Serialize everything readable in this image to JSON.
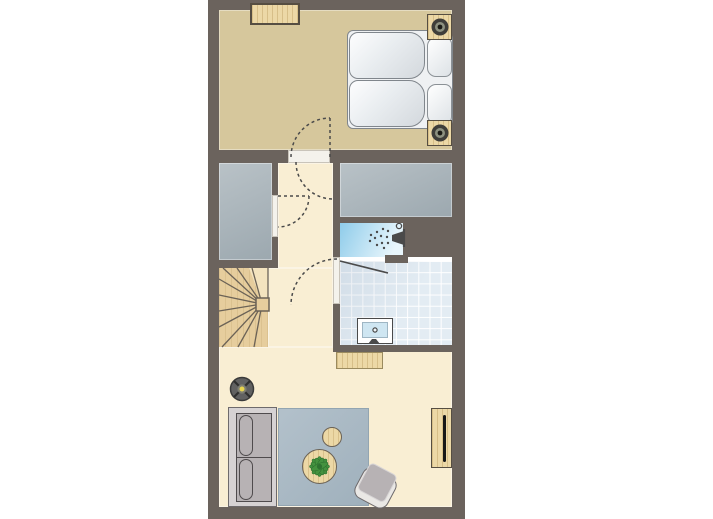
{
  "page": {
    "background": "#ffffff",
    "type": "floor-plan"
  },
  "colors": {
    "page": "#ffffff",
    "wall": "#6b635d",
    "bedroom": "#d6c79c",
    "cream": "#f9eed3",
    "grayroom-hi": "#b9c2c7",
    "grayroom-lo": "#9ca8af",
    "shower-hi": "#8fccea",
    "shower-lo": "#e9f6fc",
    "tile": "#e3ecf3",
    "grout": "#ffffff",
    "threshold": "#f4f2ec",
    "wood": "#ecd8a6",
    "wood-border": "#564e42",
    "stairs": "#e6cd9d",
    "stairs-light": "#f3e3bf",
    "stair-line": "#6b6256",
    "bed-base": "#eff1f3",
    "mattress-hi": "#fdfdfe",
    "mattress-lo": "#d3d8dd",
    "mattress-edge": "#80868c",
    "pillow-edge": "#8b9196",
    "sofa-base": "#d6d2d3",
    "sofa-edge": "#6e6a6c",
    "cushion": "#b7b2b4",
    "cushion-line": "#4f4b4d",
    "chair-shell": "#eae8e5",
    "rug-hi": "#b3c1cb",
    "rug-lo": "#9fb0bc",
    "rug-edge": "#93a5b1",
    "plant": "#44923f",
    "plant-dark": "#2e7230",
    "lamp-dark": "#3f3e3a",
    "lamp-ring": "#8d9180",
    "lamp-glow": "#e8d44e",
    "floorlamp-body": "#616161",
    "tv": "#161616",
    "sink-blue": "#cfe6f2",
    "outline": "#4a4a4a"
  },
  "rooms": [
    {
      "id": "bedroom",
      "label": "bedroom"
    },
    {
      "id": "hallway",
      "label": "hallway-landing"
    },
    {
      "id": "storage",
      "label": "storage-room"
    },
    {
      "id": "bathroom",
      "label": "bathroom-with-shower"
    },
    {
      "id": "stairs",
      "label": "winder-staircase"
    },
    {
      "id": "living",
      "label": "living-room"
    }
  ],
  "furniture": [
    {
      "room": "bedroom",
      "item": "wardrobe-dresser"
    },
    {
      "room": "bedroom",
      "item": "double-bed-two-mattresses"
    },
    {
      "room": "bedroom",
      "item": "pillows"
    },
    {
      "room": "bedroom",
      "item": "nightstand-with-lamp-top"
    },
    {
      "room": "bedroom",
      "item": "nightstand-with-lamp-bottom"
    },
    {
      "room": "bathroom",
      "item": "shower-head"
    },
    {
      "room": "bathroom",
      "item": "shower-glass-screen"
    },
    {
      "room": "bathroom",
      "item": "washbasin"
    },
    {
      "room": "living",
      "item": "cabinet-under-bathroom-wall"
    },
    {
      "room": "living",
      "item": "floor-lamp"
    },
    {
      "room": "living",
      "item": "two-seat-sofa"
    },
    {
      "room": "living",
      "item": "area-rug"
    },
    {
      "room": "living",
      "item": "round-table-with-plant"
    },
    {
      "room": "living",
      "item": "side-stool"
    },
    {
      "room": "living",
      "item": "armchair"
    },
    {
      "room": "living",
      "item": "tv-sideboard"
    }
  ],
  "doors": [
    {
      "id": "bedroom-door",
      "swing": "double-arc"
    },
    {
      "id": "storage-door",
      "swing": "into-hall"
    },
    {
      "id": "bathroom-door",
      "swing": "into-hall"
    }
  ],
  "icons": [
    "lamp-icon",
    "shower-spray-icon",
    "drain-icon",
    "plant-icon",
    "tv-icon"
  ]
}
